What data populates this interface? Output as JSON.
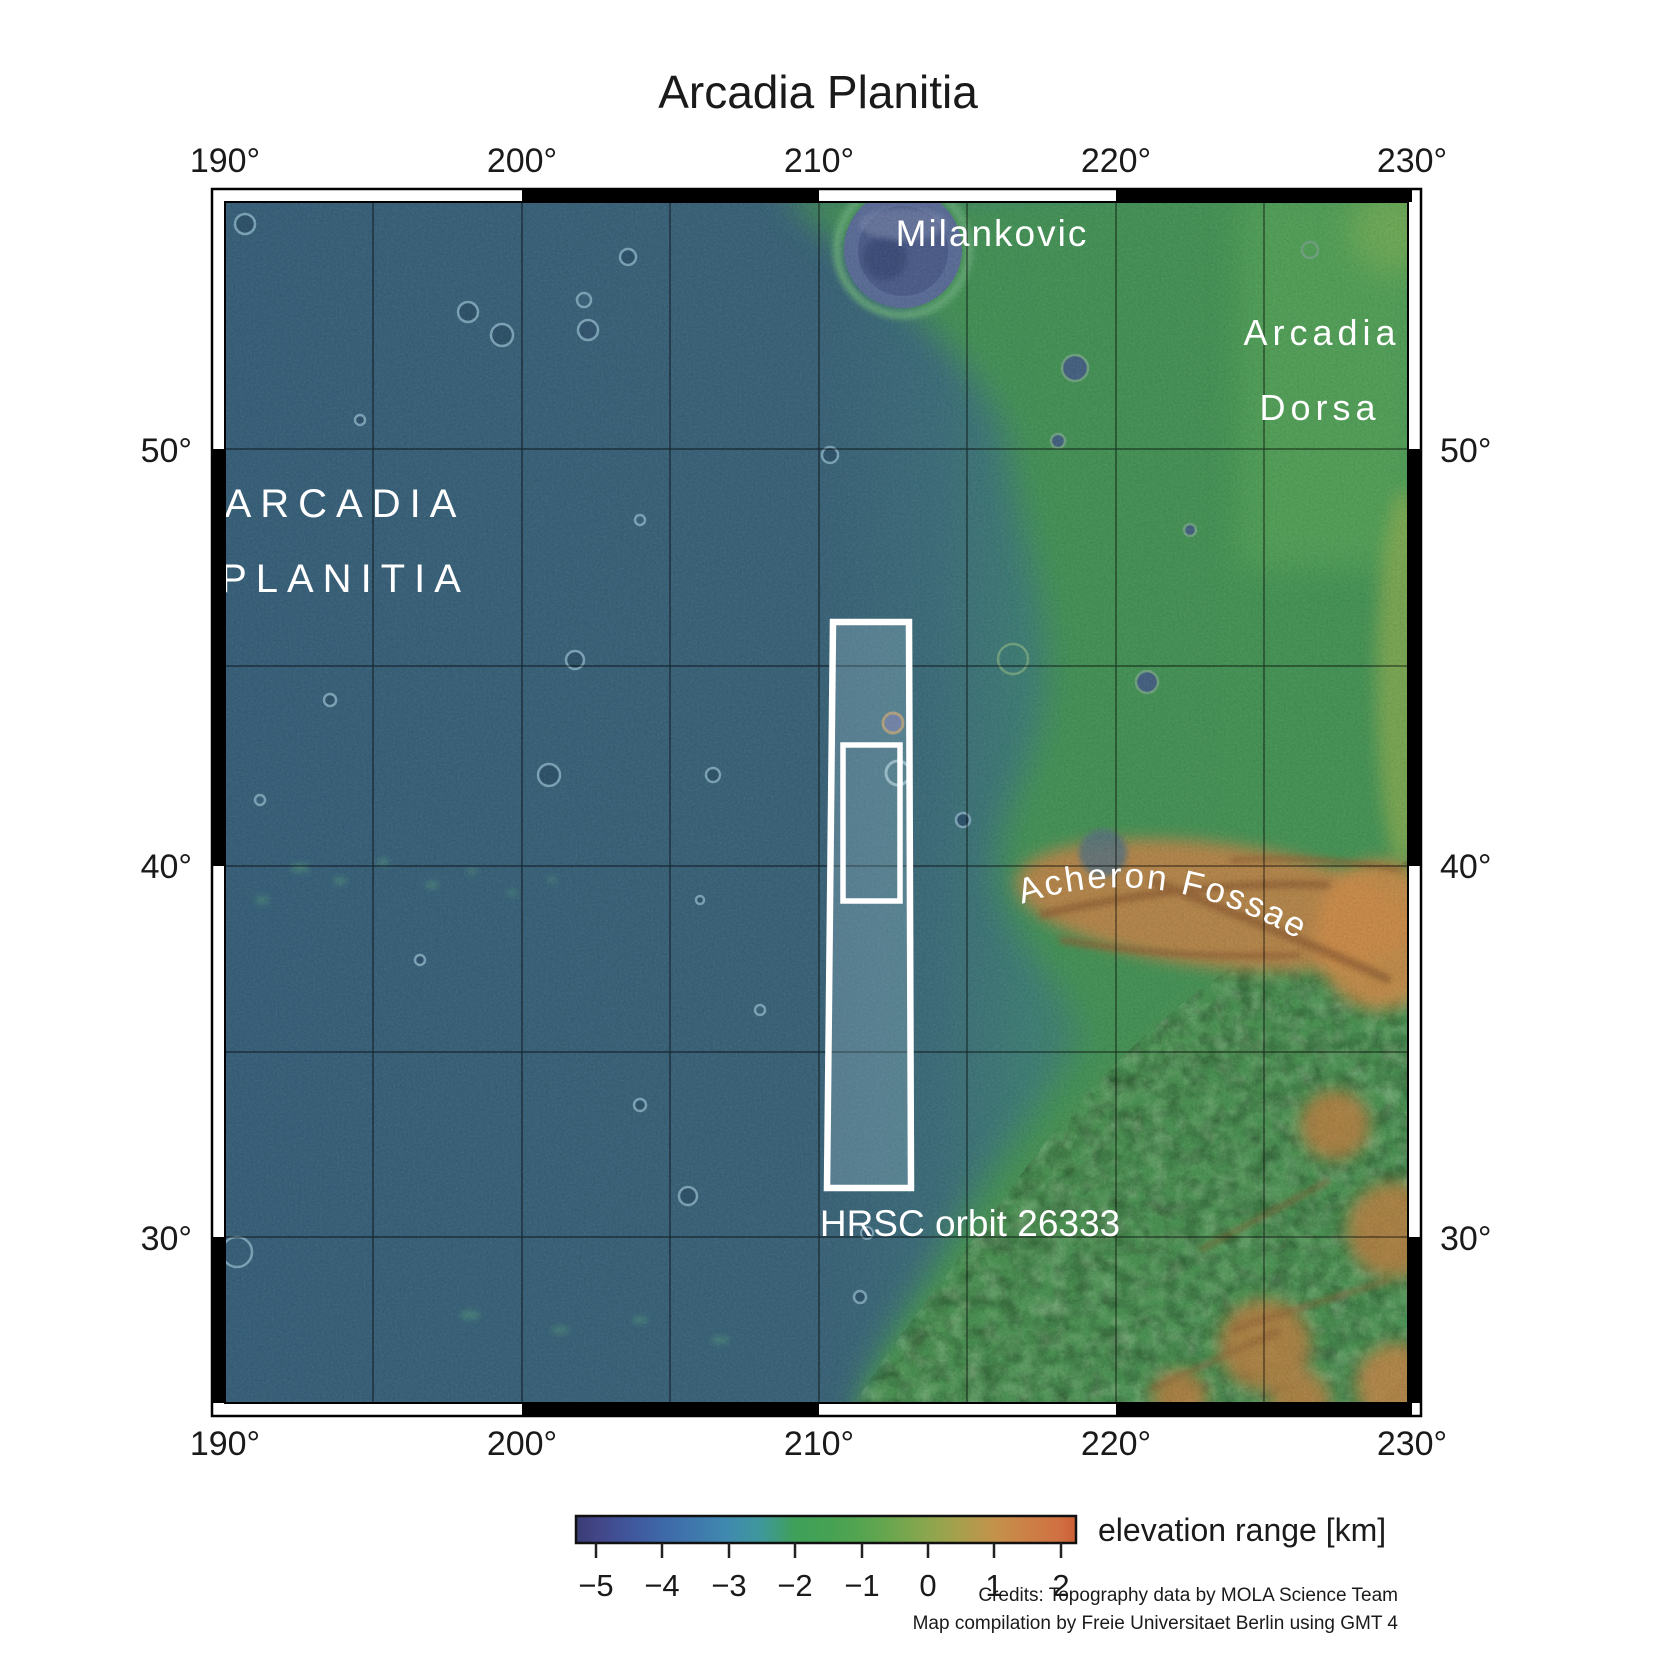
{
  "title": "Arcadia Planitia",
  "axes": {
    "lon": [
      "190°",
      "200°",
      "210°",
      "220°",
      "230°"
    ],
    "lat": [
      "50°",
      "40°",
      "30°"
    ]
  },
  "map_labels": {
    "milankovic": "Milankovic",
    "arcadia_dorsa": {
      "line1": "Arcadia",
      "line2": "Dorsa"
    },
    "arcadia_planitia": {
      "line1": "ARCADIA",
      "line2": "PLANITIA"
    },
    "acheron_fossae": "Acheron Fossae",
    "hrsc_orbit": "HRSC orbit 26333"
  },
  "colorbar": {
    "label": "elevation range [km]",
    "ticks": [
      "−5",
      "−4",
      "−3",
      "−2",
      "−1",
      "0",
      "1",
      "2"
    ],
    "min_km": -5,
    "max_km": 2,
    "gradient": [
      "#3a3c74",
      "#3e68a8",
      "#3f8aae",
      "#3fa058",
      "#55a450",
      "#8aa64e",
      "#c3924b",
      "#d06f41",
      "#cb5f36"
    ]
  },
  "credits": {
    "line1": "Credits: Topography data by MOLA Science Team",
    "line2": "Map compilation by Freie Universitaet Berlin using GMT 4"
  },
  "colors": {
    "plains_blue": "#3a6277",
    "transition_teal": "#3f7d74",
    "highlands_green": "#47925a",
    "corner_light_green": "#7fae57",
    "acheron_orange": "#c08447",
    "ridge_brown": "#8a5a30",
    "milankovic_fill": "#56648e",
    "strip_outline": "#ffffff",
    "grid_line": "#000000",
    "frame_white": "#ffffff",
    "frame_black": "#000000",
    "label_white": "#ffffff",
    "text_dark": "#1a1a1a"
  }
}
